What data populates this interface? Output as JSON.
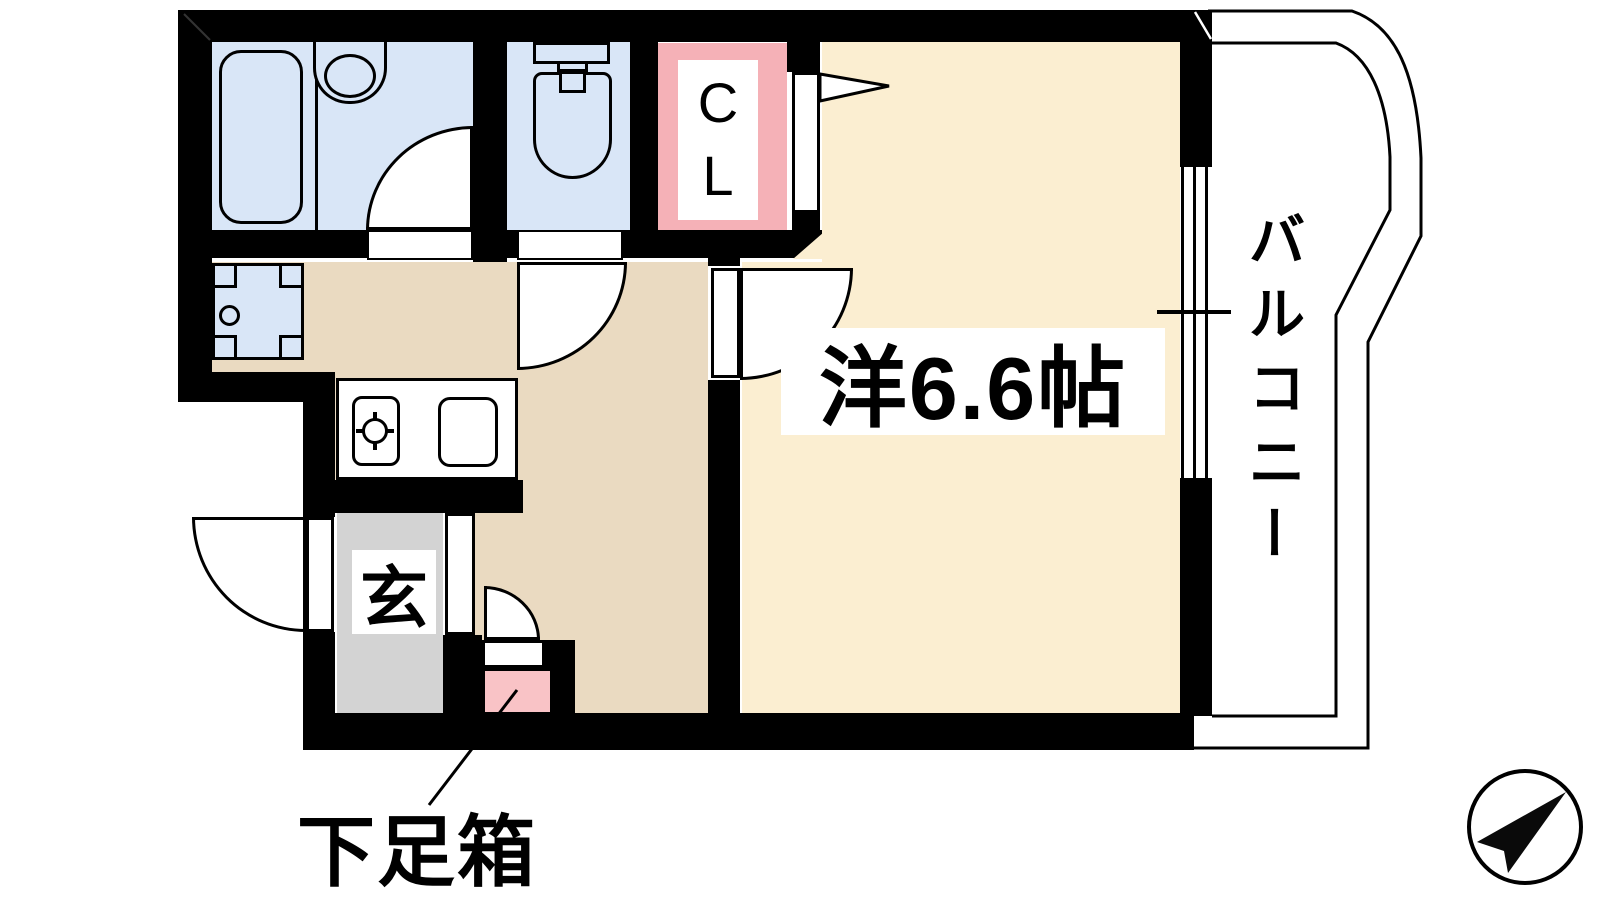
{
  "rooms": {
    "western_room": {
      "label": "洋6.6帖"
    },
    "balcony": {
      "label": "バルコニー"
    },
    "closet": {
      "label": "CL"
    },
    "entrance": {
      "label": "玄"
    },
    "shoe_box": {
      "label": "下足箱"
    }
  },
  "colors": {
    "wall": "#000000",
    "room_floor": "#FBEED1",
    "hall_floor": "#EADAC1",
    "wet_area_floor": "#D9E6F7",
    "closet_pink": "#F5B1B7",
    "shoe_box_pink": "#F9C3C6",
    "entrance_gray": "#D3D3D3",
    "outline": "#000000"
  },
  "icons": {
    "compass": "north-arrow"
  }
}
